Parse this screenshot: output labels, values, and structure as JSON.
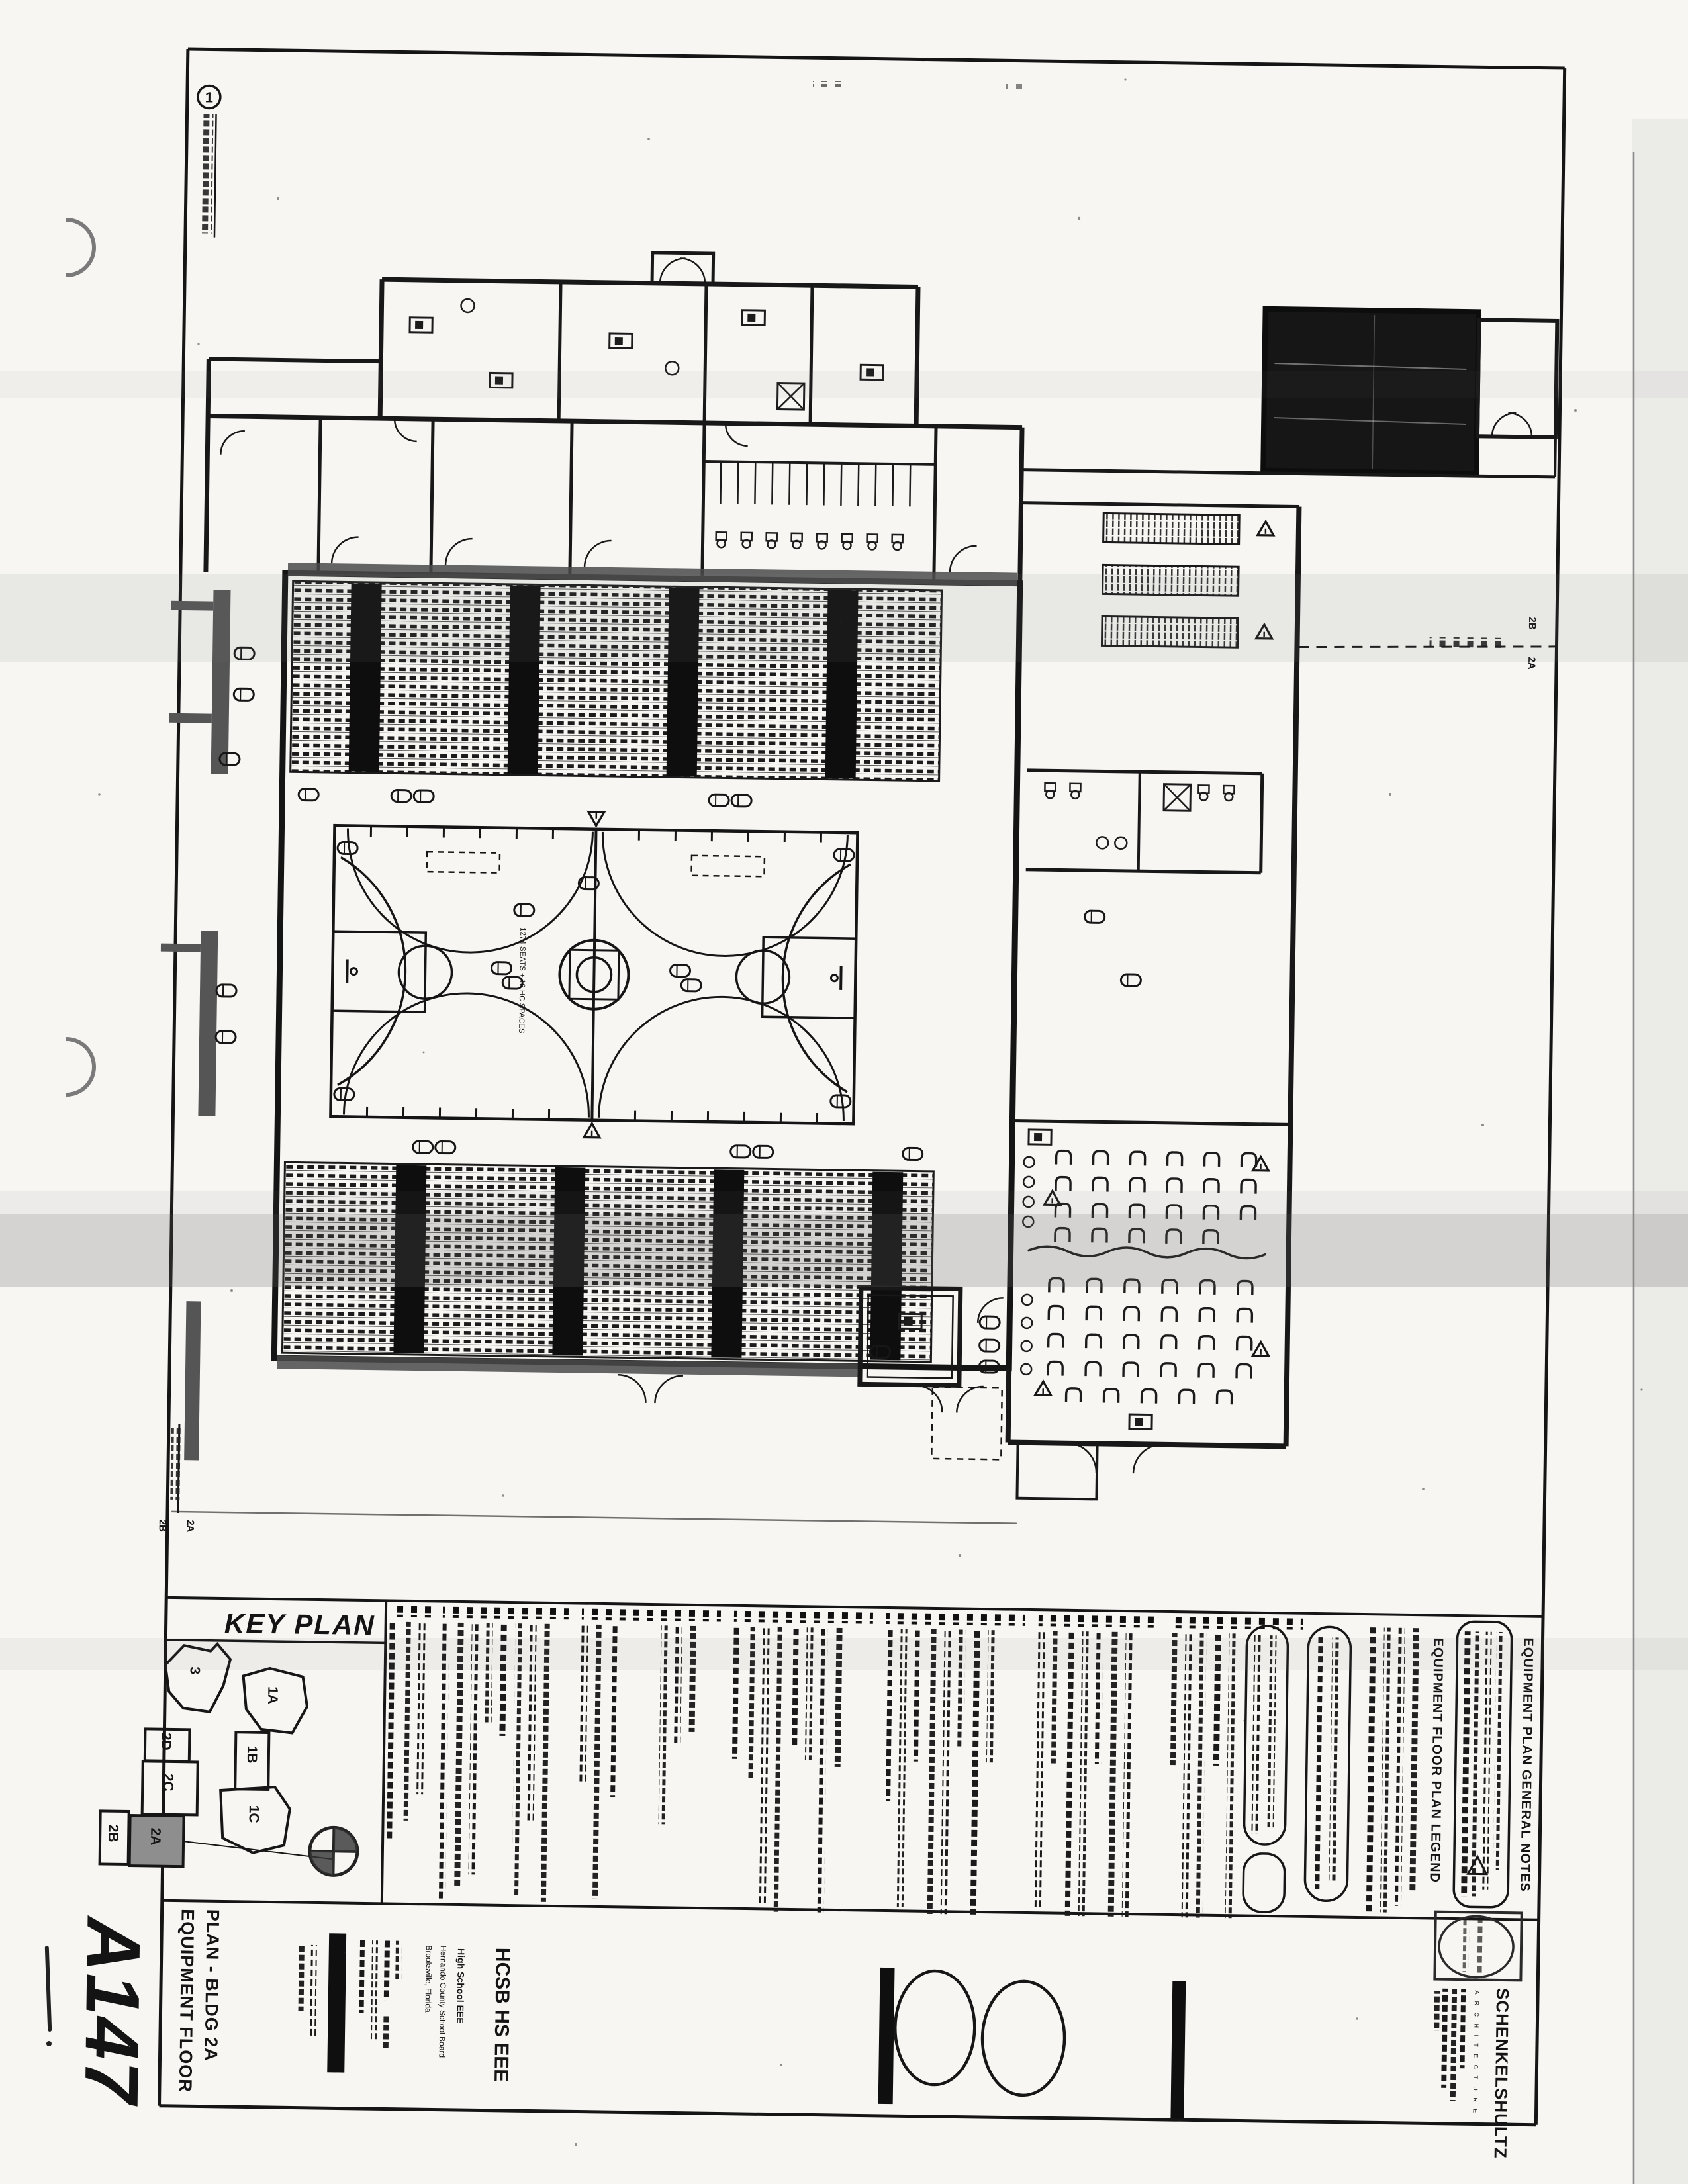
{
  "sheet": {
    "number": "A147",
    "title_line1": "EQUIPMENT FLOOR",
    "title_line2": "PLAN - BLDG 2A"
  },
  "callout": {
    "number": "1"
  },
  "project": {
    "code": "HCSB HS EEE",
    "name": "High School EEE",
    "owner": "Hernando County School Board",
    "city": "Brooksville, Florida"
  },
  "architect": {
    "firm": "SCHENKELSHULTZ",
    "discipline": "A R C H I T E C T U R E"
  },
  "key_plan": {
    "title": "KEY PLAN",
    "buildings": [
      {
        "label": "3"
      },
      {
        "label": "1A"
      },
      {
        "label": "1B"
      },
      {
        "label": "1C"
      },
      {
        "label": "2D"
      },
      {
        "label": "2C"
      },
      {
        "label": "2B"
      },
      {
        "label": "2A"
      }
    ],
    "highlighted": "2A"
  },
  "panel_titles": {
    "legend": "EQUIPMENT FLOOR PLAN LEGEND",
    "notes": "EQUIPMENT PLAN GENERAL NOTES"
  },
  "plan": {
    "matchline_label": "matchline",
    "side_a": "2A",
    "side_b": "2B",
    "seating_note": "1274 SEATS + 18 HC SPACES"
  }
}
